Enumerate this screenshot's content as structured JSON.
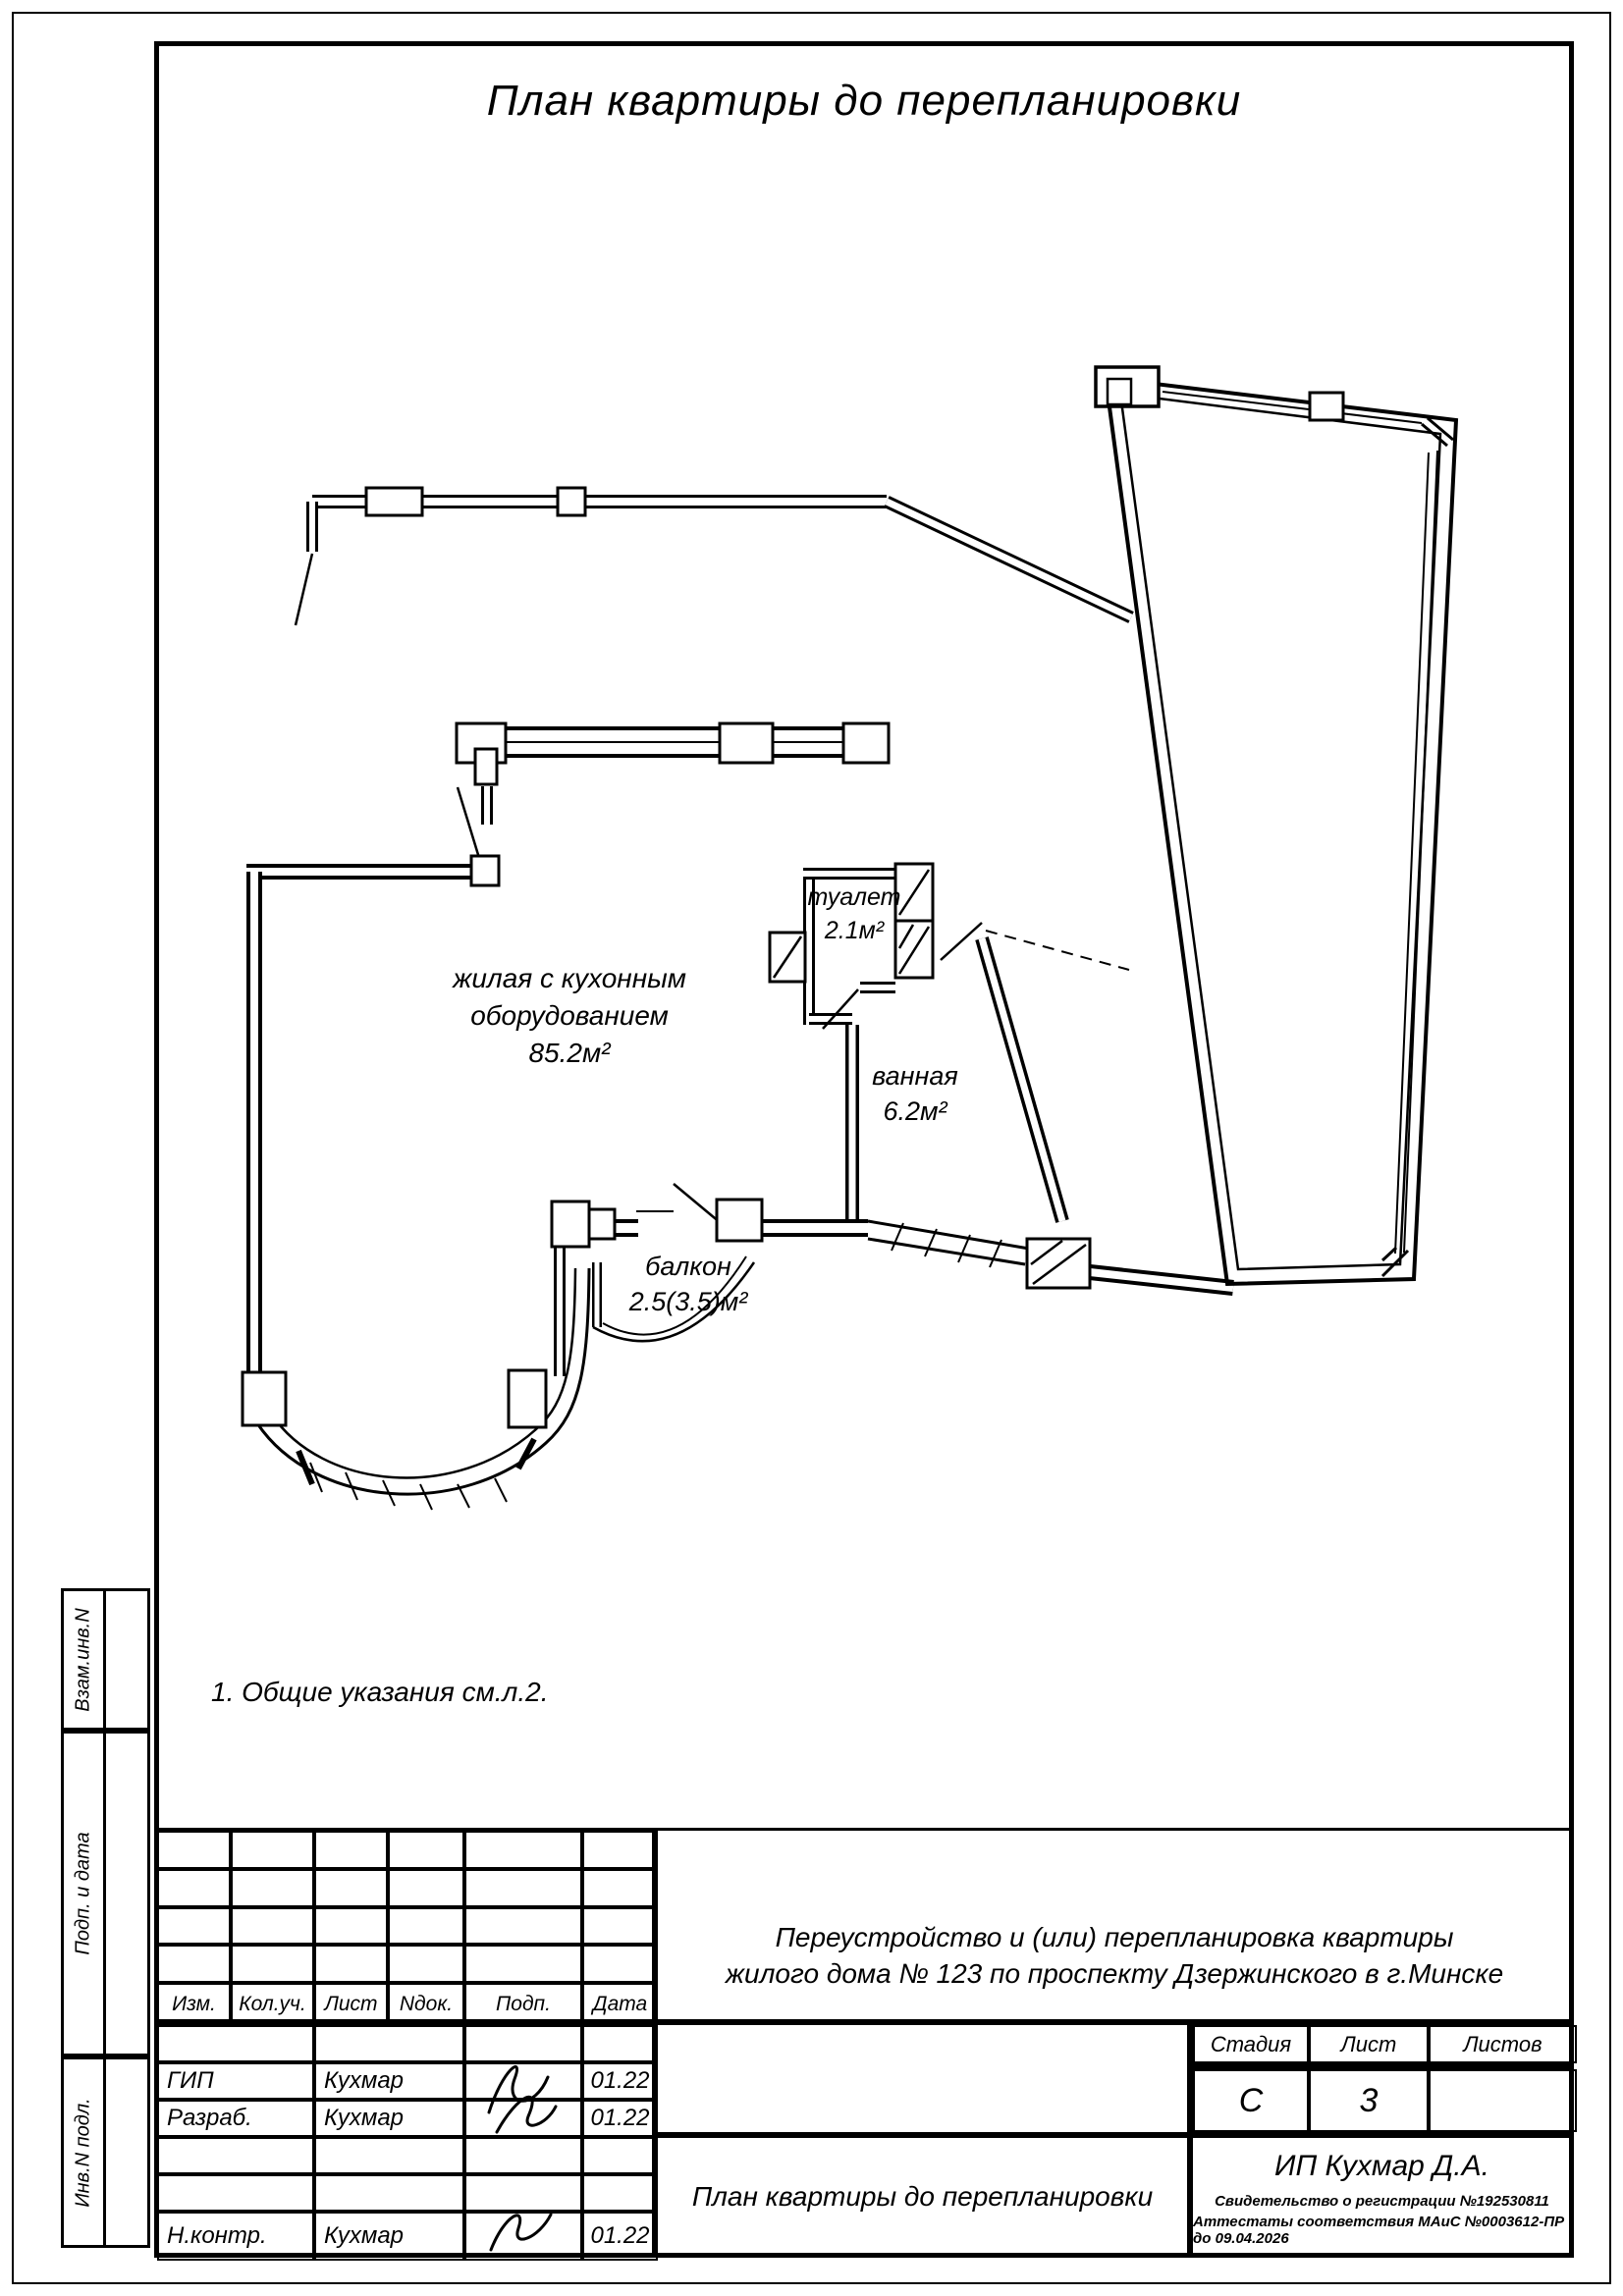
{
  "page_title": "План квартиры до перепланировки",
  "note": "1. Общие указания см.л.2.",
  "rooms": {
    "living": {
      "line1": "жилая с кухонным",
      "line2": "оборудованием",
      "area": "85.2м²"
    },
    "toilet": {
      "name": "туалет",
      "area": "2.1м²"
    },
    "bath": {
      "name": "ванная",
      "area": "6.2м²"
    },
    "balcony": {
      "name": "балкон",
      "area": "2.5(3.5)м²"
    }
  },
  "margin_labels": {
    "box1": "Взам.инв.N",
    "box2": "Подп. и дата",
    "box3": "Инв.N подл."
  },
  "title_block": {
    "header_cols": [
      "Изм.",
      "Кол.уч.",
      "Лист",
      "Nдок.",
      "Подп.",
      "Дата"
    ],
    "rows": [
      {
        "role": "ГИП",
        "name": "Кухмар",
        "date": "01.22"
      },
      {
        "role": "Разраб.",
        "name": "Кухмар",
        "date": "01.22"
      },
      {
        "role": "",
        "name": "",
        "date": ""
      },
      {
        "role": "",
        "name": "",
        "date": ""
      },
      {
        "role": "Н.контр.",
        "name": "Кухмар",
        "date": "01.22"
      }
    ],
    "description_line1": "Переустройство и (или) перепланировка квартиры",
    "description_line2": "жилого дома № 123 по проспекту Дзержинского в г.Минске",
    "stage_label": "Стадия",
    "sheet_label": "Лист",
    "sheets_label": "Листов",
    "stage_value": "С",
    "sheet_value": "3",
    "sheets_value": "",
    "drawing_title": "План квартиры до перепланировки",
    "company": "ИП Кухмар Д.А.",
    "cert1": "Свидетельство о регистрации №192530811",
    "cert2": "Аттестаты соответствия МАиС №0003612-ПР до  09.04.2026"
  }
}
